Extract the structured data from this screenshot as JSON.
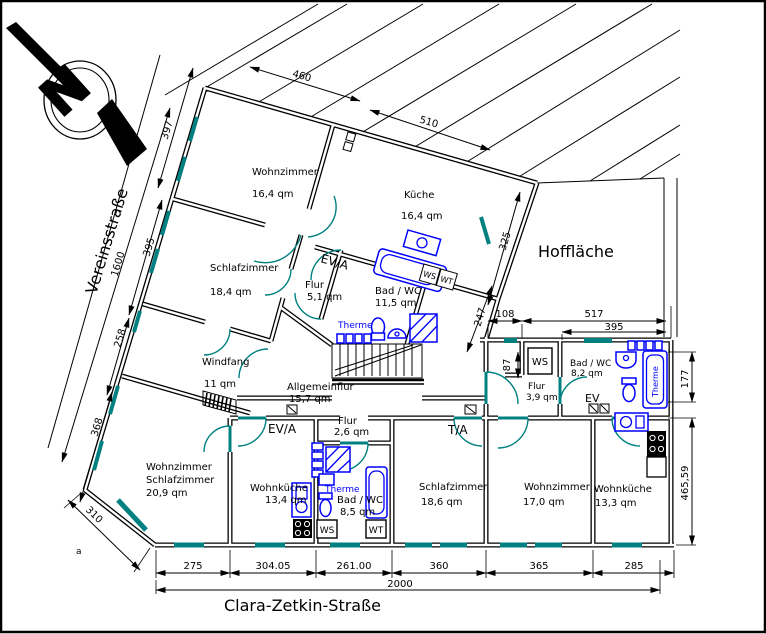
{
  "streets": {
    "left": "Vereinsstraße",
    "bottom": "Clara-Zetkin-Straße",
    "courtyard": "Hoffläche"
  },
  "compass": {
    "label": "N"
  },
  "rooms": [
    {
      "name": "Wohnzimmer",
      "area": "16,4 qm"
    },
    {
      "name": "Küche",
      "area": "16,4 qm"
    },
    {
      "name": "Schlafzimmer",
      "area": "18,4 qm"
    },
    {
      "name": "Flur",
      "area": "5,1 qm"
    },
    {
      "name": "Bad / WC",
      "area": "11,5 qm"
    },
    {
      "name": "Windfang",
      "area": "11 qm"
    },
    {
      "name": "Allgemeinflur",
      "area": "15,7 qm"
    },
    {
      "name": "Flur",
      "area": "2,6 qm"
    },
    {
      "name": "Wohnzimmer",
      "name2": "Schlafzimmer",
      "area": "20,9 qm"
    },
    {
      "name": "Wohnküche",
      "area": "13,4 qm"
    },
    {
      "name": "Bad / WC",
      "area": "8,5 qm"
    },
    {
      "name": "Schlafzimmer",
      "area": "18,6 qm"
    },
    {
      "name": "Wohnzimmer",
      "area": "17,0 qm"
    },
    {
      "name": "Wohnküche",
      "area": "13,3 qm"
    },
    {
      "name": "Bad / WC",
      "area": "8,2 qm"
    },
    {
      "name": "Flur",
      "area": "3,9 qm"
    }
  ],
  "labels": {
    "ev_a_top": "EV/A",
    "ev_a_mid": "EV/A",
    "t_a": "T/A",
    "ev": "EV",
    "ws": "WS",
    "wt": "WT",
    "therme": "Therme",
    "corner_mark": "a"
  },
  "dimensions": {
    "d397": "397",
    "d460": "460",
    "d510": "510",
    "d395_left": "395",
    "d1600": "1600",
    "d258": "258",
    "d368": "368",
    "d310": "310",
    "d325": "325",
    "d247": "247",
    "d108": "108",
    "d517": "517",
    "d395_right": "395",
    "d87": "87",
    "d177": "177",
    "d465": "465,59",
    "b1": "275",
    "b2": "304.05",
    "b3": "261.00",
    "b4": "360",
    "b5": "365",
    "b6": "285",
    "total": "2000"
  },
  "colors": {
    "wall": "#000000",
    "fixtures": "#0000ff",
    "windows_doors": "#008080",
    "background": "#ffffff"
  }
}
